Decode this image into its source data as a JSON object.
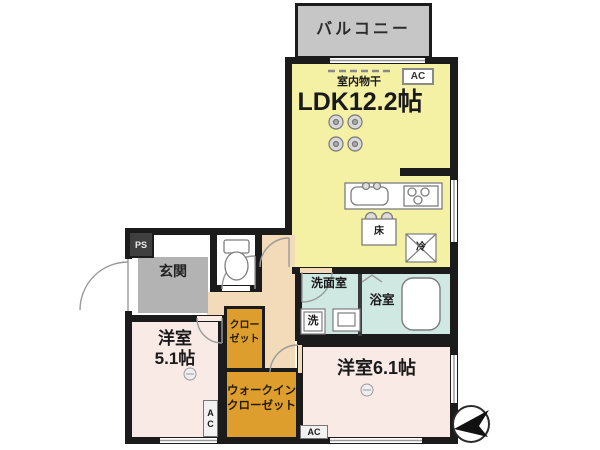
{
  "floorplan": {
    "balcony": {
      "label": "バルコニー"
    },
    "ldk": {
      "label": "LDK12.2帖",
      "indoor_drying": "室内物干",
      "ac": "AC",
      "floor_hatch": "床",
      "fridge": "冷"
    },
    "entrance": {
      "label": "玄関",
      "pipe_space": "PS"
    },
    "washroom": {
      "label": "洗面室",
      "washer": "洗"
    },
    "bathroom": {
      "label": "浴室"
    },
    "western_room_1": {
      "name": "洋室",
      "size": "5.1帖",
      "ac": "AC"
    },
    "western_room_2": {
      "label": "洋室6.1帖",
      "ac": "AC"
    },
    "closet": {
      "line1": "クロー",
      "line2": "ゼット"
    },
    "walk_in_closet": {
      "line1": "ウォークイン",
      "line2": "クローゼット"
    }
  },
  "colors": {
    "wall": "#1b1b1b",
    "ldk_yellow": "#f4f1a5",
    "balcony_gray": "#c6c6c6",
    "entrance_gray": "#b3b3b3",
    "hall_peach": "#f3dab8",
    "wet_cyan": "#cfe8e2",
    "room_pink": "#faeae6",
    "closet_orange": "#de9e2d",
    "line_gray": "#8a8a8a"
  }
}
